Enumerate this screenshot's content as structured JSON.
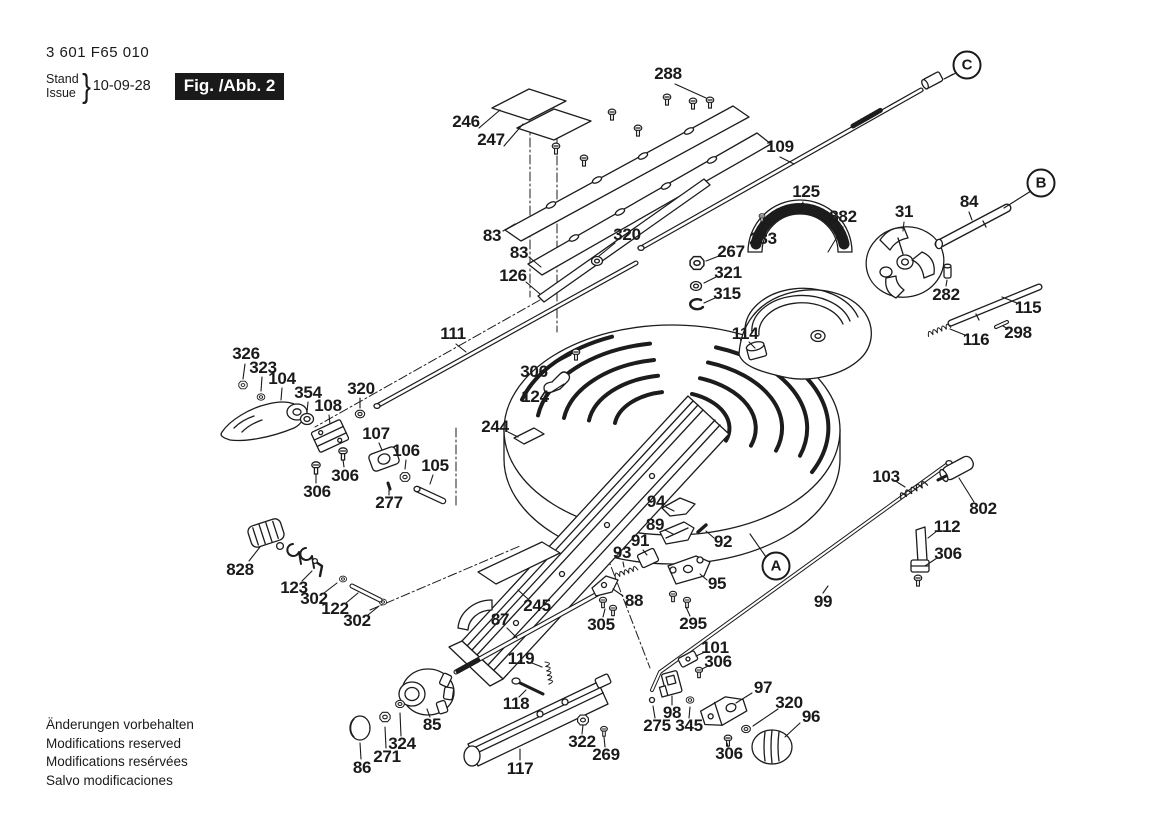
{
  "doc": {
    "part_number": "3 601 F65 010",
    "stand_label": "Stand",
    "issue_label": "Issue",
    "brace": "}",
    "date": "10-09-28",
    "figure_label": "Fig. /Abb. 2"
  },
  "footer": {
    "l1": "Änderungen vorbehalten",
    "l2": "Modifications reserved",
    "l3": "Modifications resérvées",
    "l4": "Salvo modificaciones"
  },
  "colors": {
    "ink": "#1a1a1a",
    "paper": "#ffffff"
  },
  "ref_circles": [
    {
      "t": "A",
      "x": 776,
      "y": 566,
      "l": [
        766,
        557,
        750,
        534
      ]
    },
    {
      "t": "B",
      "x": 1041,
      "y": 183,
      "l": [
        1031,
        191,
        1004,
        208
      ]
    },
    {
      "t": "C",
      "x": 967,
      "y": 65,
      "l": [
        956,
        73,
        944,
        79
      ]
    }
  ],
  "callouts": [
    {
      "t": "288",
      "x": 668,
      "y": 74,
      "l": [
        675,
        84,
        706,
        98
      ]
    },
    {
      "t": "246",
      "x": 466,
      "y": 122,
      "l": [
        479,
        128,
        500,
        110
      ]
    },
    {
      "t": "247",
      "x": 491,
      "y": 140,
      "l": [
        504,
        146,
        523,
        124
      ]
    },
    {
      "t": "83",
      "x": 492,
      "y": 236,
      "l": [
        503,
        231,
        515,
        224
      ]
    },
    {
      "t": "83",
      "x": 519,
      "y": 253,
      "l": [
        529,
        257,
        541,
        267
      ]
    },
    {
      "t": "126",
      "x": 513,
      "y": 276,
      "l": [
        526,
        282,
        540,
        294
      ]
    },
    {
      "t": "320",
      "x": 627,
      "y": 235,
      "l": [
        615,
        243,
        599,
        256
      ]
    },
    {
      "t": "109",
      "x": 780,
      "y": 147,
      "l": [
        780,
        157,
        794,
        164
      ]
    },
    {
      "t": "125",
      "x": 806,
      "y": 192,
      "l": [
        803,
        202,
        800,
        211
      ]
    },
    {
      "t": "882",
      "x": 843,
      "y": 217,
      "l": [
        843,
        227,
        828,
        252
      ]
    },
    {
      "t": "283",
      "x": 763,
      "y": 239,
      "l": [
        763,
        230,
        762,
        221
      ]
    },
    {
      "t": "31",
      "x": 904,
      "y": 212,
      "l": [
        904,
        222,
        903,
        231
      ]
    },
    {
      "t": "84",
      "x": 969,
      "y": 202,
      "l": [
        969,
        212,
        972,
        220
      ]
    },
    {
      "t": "282",
      "x": 946,
      "y": 295,
      "l": [
        946,
        286,
        947,
        280
      ]
    },
    {
      "t": "115",
      "x": 1028,
      "y": 308,
      "l": [
        1017,
        303,
        1002,
        297
      ]
    },
    {
      "t": "116",
      "x": 976,
      "y": 340,
      "l": [
        965,
        335,
        950,
        329
      ]
    },
    {
      "t": "298",
      "x": 1018,
      "y": 333,
      "l": [
        1008,
        329,
        1003,
        326
      ]
    },
    {
      "t": "267",
      "x": 731,
      "y": 252,
      "l": [
        719,
        256,
        706,
        261
      ]
    },
    {
      "t": "321",
      "x": 728,
      "y": 273,
      "l": [
        716,
        277,
        704,
        283
      ]
    },
    {
      "t": "315",
      "x": 727,
      "y": 294,
      "l": [
        715,
        298,
        704,
        303
      ]
    },
    {
      "t": "114",
      "x": 745,
      "y": 334,
      "l": [
        749,
        342,
        755,
        348
      ]
    },
    {
      "t": "111",
      "x": 453,
      "y": 334,
      "l": [
        456,
        344,
        466,
        352
      ]
    },
    {
      "t": "306",
      "x": 534,
      "y": 372,
      "l": [
        548,
        367,
        571,
        355
      ]
    },
    {
      "t": "124",
      "x": 535,
      "y": 397,
      "l": [
        550,
        393,
        564,
        384
      ]
    },
    {
      "t": "244",
      "x": 495,
      "y": 427,
      "l": [
        508,
        432,
        518,
        437
      ]
    },
    {
      "t": "326",
      "x": 246,
      "y": 354,
      "l": [
        245,
        364,
        243,
        379
      ]
    },
    {
      "t": "323",
      "x": 263,
      "y": 368,
      "l": [
        262,
        377,
        261,
        391
      ]
    },
    {
      "t": "104",
      "x": 282,
      "y": 379,
      "l": [
        282,
        388,
        281,
        400
      ]
    },
    {
      "t": "354",
      "x": 308,
      "y": 393,
      "l": [
        308,
        402,
        307,
        412
      ]
    },
    {
      "t": "108",
      "x": 328,
      "y": 406,
      "l": [
        329,
        415,
        330,
        424
      ]
    },
    {
      "t": "320",
      "x": 361,
      "y": 389,
      "l": [
        360,
        398,
        360,
        408
      ]
    },
    {
      "t": "107",
      "x": 376,
      "y": 434,
      "l": [
        379,
        443,
        382,
        450
      ]
    },
    {
      "t": "106",
      "x": 406,
      "y": 451,
      "l": [
        406,
        460,
        405,
        469
      ]
    },
    {
      "t": "105",
      "x": 435,
      "y": 466,
      "l": [
        433,
        475,
        430,
        484
      ]
    },
    {
      "t": "277",
      "x": 389,
      "y": 503,
      "l": [
        389,
        495,
        389,
        490
      ]
    },
    {
      "t": "306",
      "x": 345,
      "y": 476,
      "l": [
        344,
        467,
        343,
        460
      ]
    },
    {
      "t": "306",
      "x": 317,
      "y": 492,
      "l": [
        316,
        483,
        316,
        474
      ]
    },
    {
      "t": "94",
      "x": 656,
      "y": 502,
      "l": [
        666,
        507,
        674,
        511
      ]
    },
    {
      "t": "89",
      "x": 655,
      "y": 525,
      "l": [
        665,
        530,
        673,
        534
      ]
    },
    {
      "t": "91",
      "x": 640,
      "y": 541,
      "l": [
        643,
        550,
        647,
        555
      ]
    },
    {
      "t": "93",
      "x": 622,
      "y": 553,
      "l": [
        623,
        562,
        624,
        567
      ]
    },
    {
      "t": "92",
      "x": 723,
      "y": 542,
      "l": [
        714,
        538,
        706,
        531
      ]
    },
    {
      "t": "95",
      "x": 717,
      "y": 584,
      "l": [
        707,
        580,
        700,
        574
      ]
    },
    {
      "t": "88",
      "x": 634,
      "y": 601,
      "l": [
        623,
        596,
        613,
        589
      ]
    },
    {
      "t": "305",
      "x": 601,
      "y": 625,
      "l": [
        603,
        617,
        605,
        609
      ]
    },
    {
      "t": "295",
      "x": 693,
      "y": 624,
      "l": [
        690,
        616,
        686,
        607
      ]
    },
    {
      "t": "99",
      "x": 823,
      "y": 602,
      "l": [
        823,
        593,
        828,
        586
      ]
    },
    {
      "t": "103",
      "x": 886,
      "y": 477,
      "l": [
        897,
        482,
        905,
        487
      ]
    },
    {
      "t": "802",
      "x": 983,
      "y": 509,
      "l": [
        974,
        502,
        959,
        478
      ]
    },
    {
      "t": "112",
      "x": 947,
      "y": 527,
      "l": [
        937,
        531,
        928,
        538
      ]
    },
    {
      "t": "306",
      "x": 948,
      "y": 554,
      "l": [
        937,
        558,
        925,
        566
      ]
    },
    {
      "t": "828",
      "x": 240,
      "y": 570,
      "l": [
        249,
        561,
        260,
        547
      ]
    },
    {
      "t": "123",
      "x": 294,
      "y": 588,
      "l": [
        302,
        581,
        312,
        571
      ]
    },
    {
      "t": "302",
      "x": 314,
      "y": 599,
      "l": [
        324,
        593,
        337,
        583
      ]
    },
    {
      "t": "122",
      "x": 335,
      "y": 609,
      "l": [
        346,
        603,
        358,
        593
      ]
    },
    {
      "t": "302",
      "x": 357,
      "y": 621,
      "l": [
        368,
        615,
        379,
        606
      ]
    },
    {
      "t": "87",
      "x": 500,
      "y": 620,
      "l": [
        507,
        628,
        517,
        638
      ]
    },
    {
      "t": "245",
      "x": 537,
      "y": 606,
      "l": [
        528,
        599,
        518,
        590
      ]
    },
    {
      "t": "119",
      "x": 521,
      "y": 659,
      "l": [
        532,
        663,
        542,
        667
      ]
    },
    {
      "t": "118",
      "x": 516,
      "y": 704,
      "l": [
        519,
        697,
        526,
        690
      ]
    },
    {
      "t": "85",
      "x": 432,
      "y": 725,
      "l": [
        430,
        717,
        427,
        709
      ]
    },
    {
      "t": "117",
      "x": 520,
      "y": 769,
      "l": [
        520,
        760,
        520,
        749
      ]
    },
    {
      "t": "322",
      "x": 582,
      "y": 742,
      "l": [
        582,
        734,
        583,
        725
      ]
    },
    {
      "t": "269",
      "x": 606,
      "y": 755,
      "l": [
        605,
        747,
        604,
        737
      ]
    },
    {
      "t": "86",
      "x": 362,
      "y": 768,
      "l": [
        361,
        759,
        360,
        743
      ]
    },
    {
      "t": "271",
      "x": 387,
      "y": 757,
      "l": [
        386,
        748,
        385,
        727
      ]
    },
    {
      "t": "324",
      "x": 402,
      "y": 744,
      "l": [
        401,
        736,
        400,
        713
      ]
    },
    {
      "t": "101",
      "x": 715,
      "y": 648,
      "l": [
        705,
        652,
        696,
        656
      ]
    },
    {
      "t": "306",
      "x": 718,
      "y": 662,
      "l": [
        708,
        666,
        702,
        669
      ]
    },
    {
      "t": "98",
      "x": 672,
      "y": 713,
      "l": [
        672,
        705,
        672,
        696
      ]
    },
    {
      "t": "275",
      "x": 657,
      "y": 726,
      "l": [
        655,
        718,
        653,
        706
      ]
    },
    {
      "t": "345",
      "x": 689,
      "y": 726,
      "l": [
        689,
        718,
        690,
        707
      ]
    },
    {
      "t": "97",
      "x": 763,
      "y": 688,
      "l": [
        752,
        693,
        736,
        703
      ]
    },
    {
      "t": "320",
      "x": 789,
      "y": 703,
      "l": [
        778,
        709,
        753,
        726
      ]
    },
    {
      "t": "96",
      "x": 811,
      "y": 717,
      "l": [
        800,
        723,
        785,
        737
      ]
    },
    {
      "t": "306",
      "x": 729,
      "y": 754,
      "l": [
        728,
        747,
        727,
        743
      ]
    }
  ]
}
